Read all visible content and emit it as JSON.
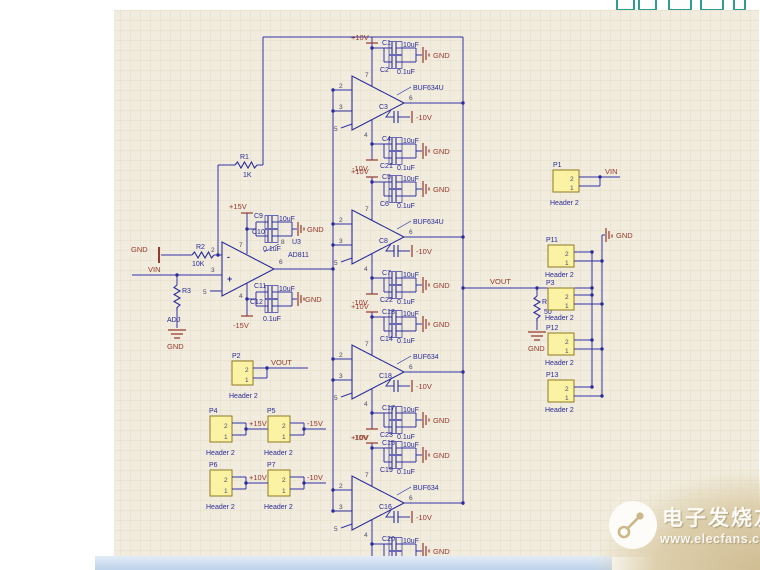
{
  "toolbar": {
    "icons": [
      "tool-icon-1",
      "tool-icon-2",
      "tool-icon-3",
      "tool-icon-4"
    ]
  },
  "watermark": {
    "brand": "电子发烧友",
    "site": "www.elecfans.com"
  },
  "schematic": {
    "nets": {
      "vin": "VIN",
      "vout": "VOUT",
      "gnd": "GND",
      "p15": "+15V",
      "m15": "-15V",
      "p10": "+10V",
      "m10": "-10V"
    },
    "pin_numbers": {
      "n1": "1",
      "n2": "2",
      "n3": "3",
      "n4": "4",
      "n5": "5",
      "n6": "6",
      "n7": "7",
      "n8": "8"
    },
    "opamp": {
      "designator": "U3",
      "part": "AD811",
      "sym_minus": "-",
      "sym_plus": "+"
    },
    "resistors": {
      "r1": {
        "ref": "R1",
        "value": "1K"
      },
      "r2": {
        "ref": "R2",
        "value": "10K"
      },
      "r3": {
        "ref": "R3",
        "value": "ADJ"
      },
      "r13": {
        "ref": "R13",
        "value": "50"
      }
    },
    "opamp_caps": {
      "c9": {
        "ref": "C9",
        "value": "10uF"
      },
      "c10": {
        "ref": "C10",
        "value": "0.1uF"
      },
      "c11": {
        "ref": "C11",
        "value": "10uF"
      },
      "c12": {
        "ref": "C12",
        "value": "0.1uF"
      }
    },
    "buffers": [
      {
        "part": "BUF634U",
        "top0": {
          "ref": "C1",
          "value": "10uF"
        },
        "top1": {
          "ref": "C2",
          "value": "0.1uF"
        },
        "mid": {
          "ref": "C3"
        },
        "bot0": {
          "ref": "C4",
          "value": "10uF"
        },
        "bot1": {
          "ref": "C21",
          "value": "0.1uF"
        }
      },
      {
        "part": "BUF634U",
        "top0": {
          "ref": "C5",
          "value": "10uF"
        },
        "top1": {
          "ref": "C6",
          "value": "0.1uF"
        },
        "mid": {
          "ref": "C8"
        },
        "bot0": {
          "ref": "C7",
          "value": "10uF"
        },
        "bot1": {
          "ref": "C22",
          "value": "0.1uF"
        }
      },
      {
        "part": "BUF634",
        "top0": {
          "ref": "C13",
          "value": "10uF"
        },
        "top1": {
          "ref": "C14",
          "value": "0.1uF"
        },
        "mid": {
          "ref": "C18"
        },
        "bot0": {
          "ref": "C17",
          "value": "10uF"
        },
        "bot1": {
          "ref": "C23",
          "value": "0.1uF"
        }
      },
      {
        "part": "BUF634",
        "top0": {
          "ref": "C15",
          "value": "10uF"
        },
        "top1": {
          "ref": "C19",
          "value": "0.1uF"
        },
        "mid": {
          "ref": "C16"
        },
        "bot0": {
          "ref": "C20",
          "value": "10uF"
        },
        "bot1": {
          "ref": "C24",
          "value": "0.1uF"
        }
      }
    ],
    "headers": {
      "type_label": "Header 2",
      "pins": [
        "2",
        "1"
      ],
      "right": [
        {
          "ref": "P1",
          "net": "VIN"
        },
        {
          "ref": "P11",
          "net": ""
        },
        {
          "ref": "P3",
          "net": ""
        },
        {
          "ref": "P12",
          "net": ""
        },
        {
          "ref": "P13",
          "net": ""
        }
      ],
      "left": [
        {
          "ref": "P2",
          "net": "VOUT"
        },
        {
          "ref": "P4",
          "net": "+15V"
        },
        {
          "ref": "P5",
          "net": "-15V"
        },
        {
          "ref": "P6",
          "net": "+10V"
        },
        {
          "ref": "P7",
          "net": "-10V"
        }
      ]
    }
  },
  "colors": {
    "wire": "#3232a6",
    "power_label": "#96392e",
    "canvas": "#f1ecdd",
    "grid": "#e2dcc6",
    "header_fill": "#fbf3a3",
    "toolbar_icon": "#2e9e8e"
  }
}
